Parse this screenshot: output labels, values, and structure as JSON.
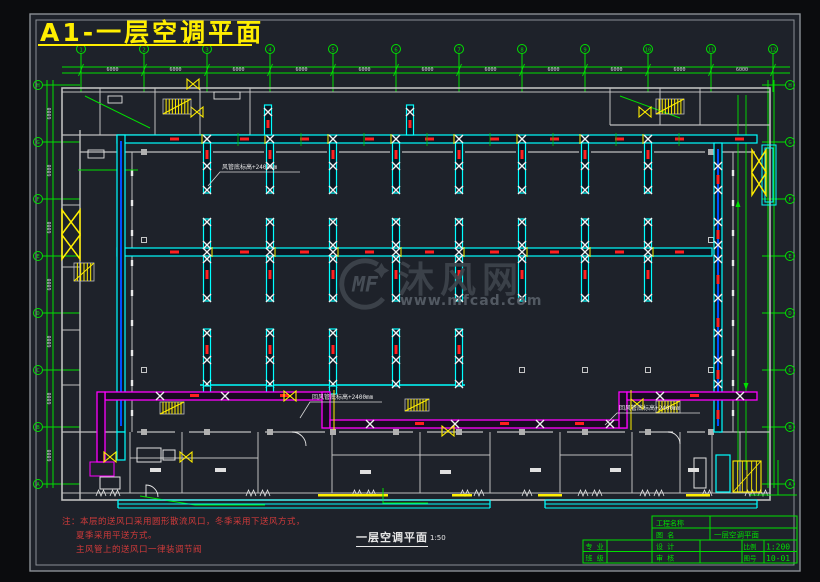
{
  "title": "A1-一层空调平面",
  "watermark": {
    "logo_text": "MF",
    "site_name": "沐风网",
    "site_url": "www.mfcad.com"
  },
  "notes": {
    "lines": [
      "注：本层的送风口采用圆形散流风口，冬季采用下送风方式，",
      "夏季采用平送方式。",
      "主风管上的送风口一律装调节阀"
    ]
  },
  "drawing_label": {
    "name": "一层空调平面",
    "scale": "1:50"
  },
  "title_block": {
    "project_label": "工程名称",
    "project_value": "",
    "drawing_name_label": "图  名",
    "drawing_name_value": "一层空调平面",
    "major_label": "专 业",
    "class_label": "班 级",
    "design_label": "设 计",
    "check_label": "审 核",
    "scale_label": "比例",
    "scale_value": "1:200",
    "number_label": "图号",
    "number_value": "10-01"
  },
  "axes": {
    "top_numbers": [
      "1",
      "2",
      "3",
      "4",
      "5",
      "6",
      "7",
      "8",
      "9",
      "10",
      "11",
      "12"
    ],
    "side_letters": [
      "H",
      "G",
      "F",
      "E",
      "D",
      "C",
      "B",
      "A"
    ],
    "top_dims": [
      "6000",
      "6000",
      "6000",
      "6000",
      "6000",
      "6000",
      "6000",
      "6000",
      "6000",
      "6000",
      "6000"
    ],
    "side_dims": [
      "6000",
      "6000",
      "6000",
      "6000",
      "6000",
      "6000",
      "6000"
    ]
  },
  "annotations": [
    {
      "text": "风管底标高+2400mm"
    },
    {
      "text": "回风管底标高+2400mm"
    },
    {
      "text": "回风管底标高+2400mm"
    }
  ],
  "colors": {
    "background": "#1e222a",
    "page": "#0b0c0e",
    "axis_green": "#00e000",
    "duct_cyan": "#00ffff",
    "return_magenta": "#ff00ff",
    "symbol_yellow": "#ffee00",
    "flag_red": "#ff2020",
    "wall_gray": "#bfbfbf",
    "text_white": "#e8e8e8",
    "watermark_gray": "#3e444c"
  }
}
